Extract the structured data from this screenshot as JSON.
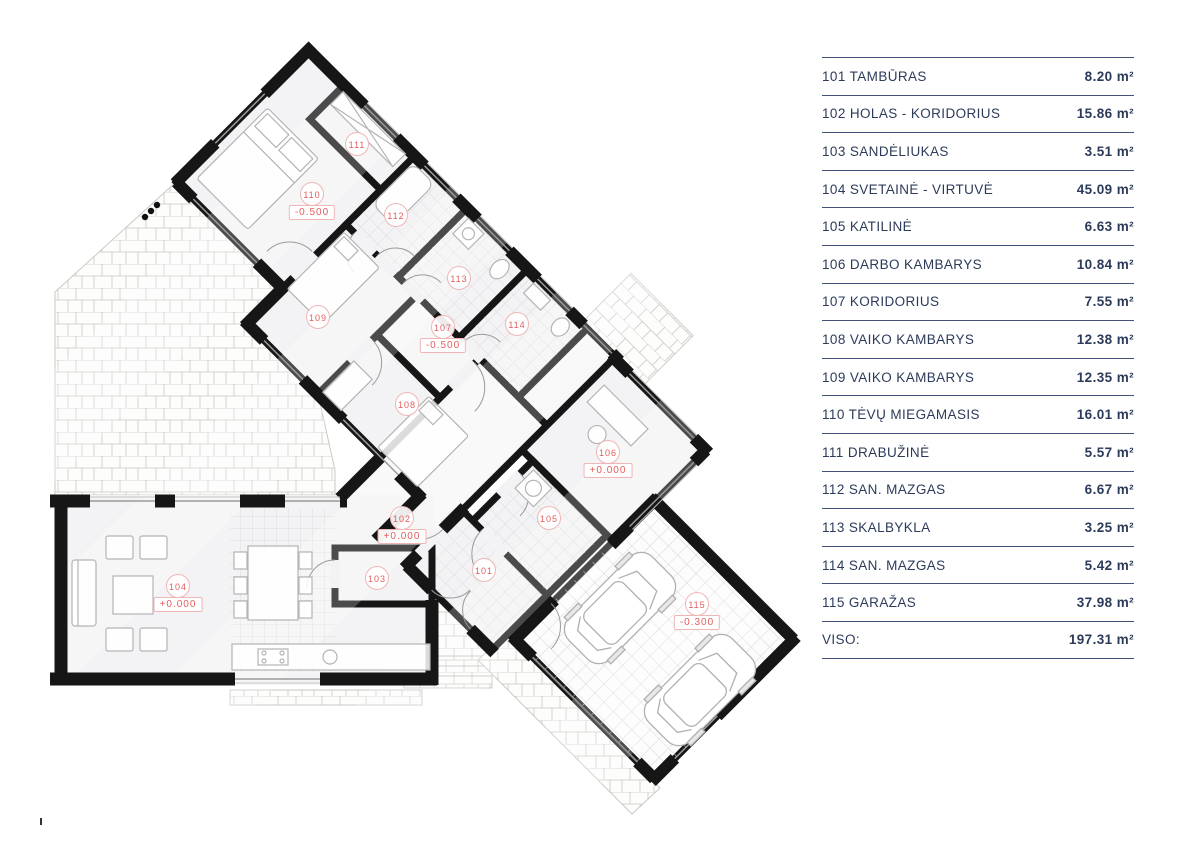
{
  "legend": {
    "rows": [
      {
        "label": "101 TAMBŪRAS",
        "value": "8.20 m²"
      },
      {
        "label": "102 HOLAS - KORIDORIUS",
        "value": "15.86 m²"
      },
      {
        "label": "103 SANDĖLIUKAS",
        "value": "3.51 m²"
      },
      {
        "label": "104 SVETAINĖ - VIRTUVĖ",
        "value": "45.09 m²"
      },
      {
        "label": "105 KATILINĖ",
        "value": "6.63 m²"
      },
      {
        "label": "106 DARBO KAMBARYS",
        "value": "10.84 m²"
      },
      {
        "label": "107 KORIDORIUS",
        "value": "7.55 m²"
      },
      {
        "label": "108 VAIKO KAMBARYS",
        "value": "12.38 m²"
      },
      {
        "label": "109 VAIKO KAMBARYS",
        "value": "12.35 m²"
      },
      {
        "label": "110 TĖVŲ MIEGAMASIS",
        "value": "16.01 m²"
      },
      {
        "label": "111 DRABUŽINĖ",
        "value": "5.57 m²"
      },
      {
        "label": "112 SAN. MAZGAS",
        "value": "6.67 m²"
      },
      {
        "label": "113 SKALBYKLA",
        "value": "3.25 m²"
      },
      {
        "label": "114 SAN. MAZGAS",
        "value": "5.42 m²"
      },
      {
        "label": "115 GARAŽAS",
        "value": "37.98 m²"
      }
    ],
    "total": {
      "label": "VISO:",
      "value": "197.31 m²"
    }
  },
  "floor_plan": {
    "rooms": [
      {
        "number": "101",
        "x": 484,
        "y": 570
      },
      {
        "number": "102",
        "x": 402,
        "y": 518,
        "elevation": "+0.000"
      },
      {
        "number": "103",
        "x": 377,
        "y": 578
      },
      {
        "number": "104",
        "x": 178,
        "y": 586,
        "elevation": "+0.000"
      },
      {
        "number": "105",
        "x": 549,
        "y": 518
      },
      {
        "number": "106",
        "x": 608,
        "y": 452,
        "elevation": "+0.000"
      },
      {
        "number": "107",
        "x": 443,
        "y": 327,
        "elevation": "-0.500"
      },
      {
        "number": "108",
        "x": 407,
        "y": 404
      },
      {
        "number": "109",
        "x": 318,
        "y": 317
      },
      {
        "number": "110",
        "x": 312,
        "y": 194,
        "elevation": "-0.500"
      },
      {
        "number": "111",
        "x": 357,
        "y": 144
      },
      {
        "number": "112",
        "x": 396,
        "y": 215
      },
      {
        "number": "113",
        "x": 459,
        "y": 278
      },
      {
        "number": "114",
        "x": 517,
        "y": 324
      },
      {
        "number": "115",
        "x": 697,
        "y": 604,
        "elevation": "-0.300"
      }
    ]
  },
  "colors": {
    "text_navy": "#2c3b5a",
    "line_navy": "#42517a",
    "accent_red": "#e25d5d",
    "label_border": "#f0b6b6",
    "wall_black": "#161616"
  }
}
